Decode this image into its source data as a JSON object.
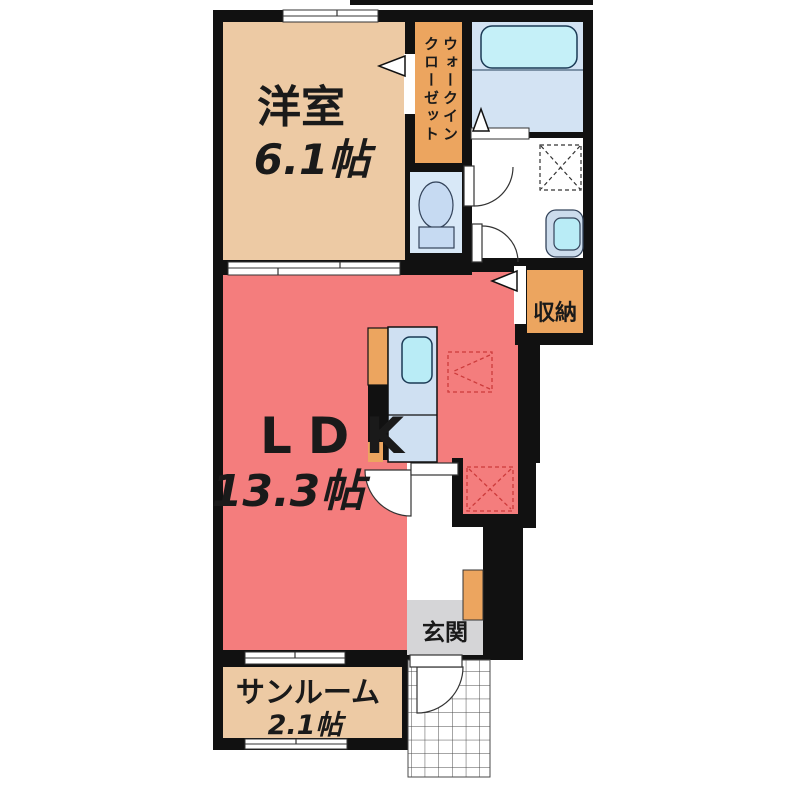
{
  "plan": {
    "rooms": {
      "western": {
        "name": "洋室",
        "size": "6.1帖"
      },
      "wic": {
        "line1": "ウォークイン",
        "line2": "クローゼット"
      },
      "ldk": {
        "name": "LDK",
        "size": "13.3帖"
      },
      "storage": {
        "name": "収納"
      },
      "entrance": {
        "name": "玄関"
      },
      "sunroom": {
        "name": "サンルーム",
        "size": "2.1帖"
      }
    },
    "colors": {
      "wall": "#111111",
      "peach": "#edcaa4",
      "orange": "#eca55f",
      "salmon": "#f47d7d",
      "bath_floor": "#d3e3f3",
      "tub": "#c5f0f8",
      "toilet_floor": "#d8e8f7",
      "fixture_blue": "#c6daf2",
      "sink": "#b9ecf6",
      "counter_blue": "#cfe0f2",
      "genkan_gray": "#d5d5d7",
      "dash_red": "#cc3b3b",
      "text": "#1a1a1a"
    }
  }
}
